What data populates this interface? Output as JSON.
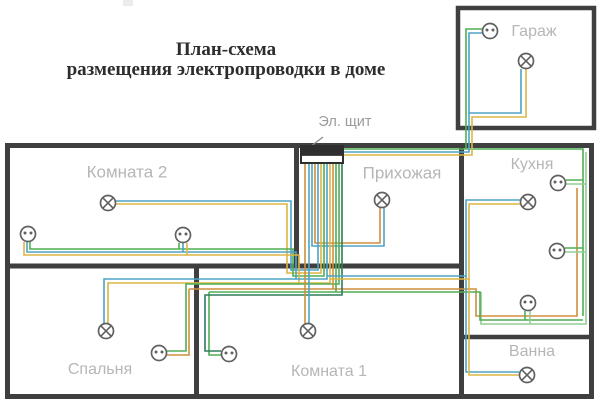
{
  "title": {
    "line1": "План-схема",
    "line2": "размещения электропроводки в доме"
  },
  "colors": {
    "wall": "#3f3f3f",
    "teal": "#4ea3c4",
    "yellow": "#dcb544",
    "green": "#4fae54",
    "lgreen": "#93cb94",
    "orange": "#cf8f3e",
    "dgreen": "#2e7d5b",
    "symbol_stroke": "#606060",
    "label_gray": "#b6b6b6",
    "panel_label_gray": "#9c9c9c",
    "title_color": "#2d2d2d"
  },
  "labels": [
    {
      "name": "room-label-garage",
      "text": "Гараж",
      "x": 534,
      "y": 32,
      "size": 16,
      "color": "#b6b6b6"
    },
    {
      "name": "room-label-room2",
      "text": "Комната 2",
      "x": 127,
      "y": 173,
      "size": 17,
      "color": "#b6b6b6"
    },
    {
      "name": "room-label-hallway",
      "text": "Прихожая",
      "x": 402,
      "y": 174,
      "size": 17,
      "color": "#b6b6b6"
    },
    {
      "name": "room-label-kitchen",
      "text": "Кухня",
      "x": 532,
      "y": 165,
      "size": 16,
      "color": "#b6b6b6"
    },
    {
      "name": "panel-label",
      "text": "Эл. щит",
      "x": 345,
      "y": 122,
      "size": 14.5,
      "color": "#9c9c9c"
    },
    {
      "name": "room-label-bedroom",
      "text": "Спальня",
      "x": 100,
      "y": 370,
      "size": 16,
      "color": "#b6b6b6"
    },
    {
      "name": "room-label-room1",
      "text": "Комната 1",
      "x": 329,
      "y": 372,
      "size": 16,
      "color": "#b6b6b6"
    },
    {
      "name": "room-label-bath",
      "text": "Ванна",
      "x": 532,
      "y": 352,
      "size": 16,
      "color": "#b6b6b6"
    }
  ],
  "walls": [
    {
      "x": 7.5,
      "y": 145.5,
      "w": 584,
      "h": 251,
      "sw": 5
    },
    {
      "x": 458,
      "y": 8,
      "w": 136,
      "h": 120,
      "sw": 4.5
    },
    {
      "x1": 296.5,
      "y1": 145,
      "x2": 296.5,
      "y2": 266,
      "sw": 5
    },
    {
      "x1": 5,
      "y1": 266,
      "x2": 461,
      "y2": 266,
      "sw": 5
    },
    {
      "x1": 461.5,
      "y1": 145,
      "x2": 461.5,
      "y2": 397,
      "sw": 5
    },
    {
      "x1": 196.5,
      "y1": 266,
      "x2": 196.5,
      "y2": 397,
      "sw": 5
    },
    {
      "x1": 459,
      "y1": 337,
      "x2": 592,
      "y2": 337,
      "sw": 4.5
    }
  ],
  "panel": {
    "x": 301,
    "y": 146,
    "w": 42,
    "h": 17,
    "pointer": [
      323,
      137,
      310,
      147
    ]
  },
  "wires": [
    {
      "color": "green",
      "points": [
        [
          343,
          149
        ],
        [
          583,
          149
        ],
        [
          583,
          316
        ]
      ]
    },
    {
      "color": "green",
      "points": [
        [
          466,
          149
        ],
        [
          466,
          29
        ],
        [
          482,
          29
        ]
      ]
    },
    {
      "color": "teal",
      "points": [
        [
          343,
          152
        ],
        [
          469,
          152
        ],
        [
          469,
          33
        ],
        [
          482,
          33
        ]
      ]
    },
    {
      "color": "teal",
      "points": [
        [
          469,
          113
        ],
        [
          521,
          113
        ],
        [
          521,
          69
        ]
      ]
    },
    {
      "color": "yellow",
      "points": [
        [
          343,
          155
        ],
        [
          472,
          155
        ],
        [
          472,
          117
        ],
        [
          526,
          117
        ],
        [
          526,
          69
        ]
      ]
    },
    {
      "color": "lgreen",
      "points": [
        [
          586,
          152
        ],
        [
          586,
          324
        ],
        [
          481,
          324
        ],
        [
          481,
          292
        ]
      ]
    },
    {
      "color": "orange",
      "points": [
        [
          315,
          163
        ],
        [
          315,
          243
        ],
        [
          380,
          243
        ],
        [
          380,
          208
        ]
      ]
    },
    {
      "color": "teal",
      "points": [
        [
          312,
          163
        ],
        [
          312,
          246
        ],
        [
          384,
          246
        ],
        [
          384,
          208
        ]
      ]
    },
    {
      "color": "teal",
      "points": [
        [
          115,
          201
        ],
        [
          291,
          201
        ],
        [
          291,
          270
        ],
        [
          318,
          270
        ],
        [
          318,
          163
        ]
      ]
    },
    {
      "color": "yellow",
      "points": [
        [
          115,
          204
        ],
        [
          287,
          204
        ],
        [
          287,
          273
        ],
        [
          321,
          273
        ],
        [
          321,
          163
        ]
      ]
    },
    {
      "color": "green",
      "points": [
        [
          30,
          242
        ],
        [
          30,
          249
        ],
        [
          293,
          249
        ],
        [
          293,
          276
        ],
        [
          324,
          276
        ],
        [
          324,
          163
        ]
      ]
    },
    {
      "color": "teal",
      "points": [
        [
          27,
          242
        ],
        [
          27,
          252
        ],
        [
          296,
          252
        ],
        [
          296,
          279
        ]
      ]
    },
    {
      "color": "yellow",
      "points": [
        [
          24,
          242
        ],
        [
          24,
          255
        ],
        [
          299,
          255
        ],
        [
          299,
          283
        ]
      ]
    },
    {
      "color": "green",
      "points": [
        [
          179,
          243
        ],
        [
          179,
          249
        ]
      ]
    },
    {
      "color": "teal",
      "points": [
        [
          183,
          243
        ],
        [
          183,
          252
        ]
      ]
    },
    {
      "color": "yellow",
      "points": [
        [
          187,
          243
        ],
        [
          187,
          255
        ]
      ]
    },
    {
      "color": "teal",
      "points": [
        [
          327,
          163
        ],
        [
          327,
          279
        ],
        [
          104,
          279
        ],
        [
          104,
          324
        ]
      ]
    },
    {
      "color": "yellow",
      "points": [
        [
          330,
          163
        ],
        [
          330,
          283
        ],
        [
          108,
          283
        ],
        [
          108,
          324
        ]
      ]
    },
    {
      "color": "green",
      "points": [
        [
          339,
          163
        ],
        [
          339,
          284
        ],
        [
          186,
          284
        ],
        [
          186,
          351
        ],
        [
          167,
          351
        ]
      ]
    },
    {
      "color": "orange",
      "points": [
        [
          167,
          355
        ],
        [
          189,
          355
        ],
        [
          189,
          289
        ]
      ]
    },
    {
      "color": "orange",
      "points": [
        [
          333,
          163
        ],
        [
          333,
          289
        ]
      ]
    },
    {
      "color": "orange",
      "points": [
        [
          189,
          289
        ],
        [
          476,
          289
        ],
        [
          476,
          316
        ],
        [
          577,
          316
        ],
        [
          577,
          188
        ]
      ]
    },
    {
      "color": "green",
      "points": [
        [
          209,
          292
        ],
        [
          480,
          292
        ],
        [
          480,
          320
        ],
        [
          583,
          320
        ]
      ]
    },
    {
      "color": "green",
      "points": [
        [
          336,
          163
        ],
        [
          336,
          292
        ]
      ]
    },
    {
      "color": "green",
      "points": [
        [
          221,
          355
        ],
        [
          209,
          355
        ],
        [
          209,
          292
        ]
      ]
    },
    {
      "color": "dgreen",
      "points": [
        [
          221,
          351
        ],
        [
          205,
          351
        ],
        [
          205,
          295
        ],
        [
          342,
          295
        ],
        [
          342,
          163
        ]
      ]
    },
    {
      "color": "orange",
      "points": [
        [
          305,
          163
        ],
        [
          305,
          324
        ]
      ]
    },
    {
      "color": "teal",
      "points": [
        [
          309,
          163
        ],
        [
          309,
          324
        ]
      ]
    },
    {
      "color": "teal",
      "points": [
        [
          327,
          276
        ],
        [
          466,
          276
        ],
        [
          466,
          200
        ],
        [
          520,
          200
        ]
      ]
    },
    {
      "color": "teal",
      "points": [
        [
          466,
          276
        ],
        [
          466,
          372
        ],
        [
          519,
          372
        ]
      ]
    },
    {
      "color": "yellow",
      "points": [
        [
          330,
          279
        ],
        [
          469,
          279
        ],
        [
          469,
          204
        ],
        [
          520,
          204
        ]
      ]
    },
    {
      "color": "yellow",
      "points": [
        [
          469,
          279
        ],
        [
          469,
          375
        ],
        [
          519,
          375
        ]
      ]
    },
    {
      "color": "green",
      "points": [
        [
          566,
          180
        ],
        [
          583,
          180
        ]
      ]
    },
    {
      "color": "lgreen",
      "points": [
        [
          566,
          184
        ],
        [
          586,
          184
        ]
      ]
    },
    {
      "color": "green",
      "points": [
        [
          565,
          248
        ],
        [
          583,
          248
        ]
      ]
    },
    {
      "color": "lgreen",
      "points": [
        [
          565,
          252
        ],
        [
          586,
          252
        ]
      ]
    },
    {
      "color": "green",
      "points": [
        [
          525,
          320
        ],
        [
          525,
          311
        ]
      ]
    },
    {
      "color": "lgreen",
      "points": [
        [
          530,
          324
        ],
        [
          530,
          311
        ]
      ]
    }
  ],
  "symbols": [
    {
      "type": "socket",
      "name": "socket-icon-garage",
      "x": 490,
      "y": 31
    },
    {
      "type": "lamp",
      "name": "lamp-icon-garage",
      "x": 526,
      "y": 61
    },
    {
      "type": "lamp",
      "name": "lamp-icon-room2",
      "x": 108,
      "y": 203
    },
    {
      "type": "socket",
      "name": "socket-icon-room2-left",
      "x": 28,
      "y": 234
    },
    {
      "type": "socket",
      "name": "socket-icon-room2-right",
      "x": 183,
      "y": 235
    },
    {
      "type": "lamp",
      "name": "lamp-icon-hallway",
      "x": 382,
      "y": 200
    },
    {
      "type": "lamp",
      "name": "lamp-icon-kitchen",
      "x": 528,
      "y": 202
    },
    {
      "type": "socket",
      "name": "socket-icon-kitchen-top",
      "x": 558,
      "y": 183
    },
    {
      "type": "socket",
      "name": "socket-icon-kitchen-mid",
      "x": 557,
      "y": 251
    },
    {
      "type": "socket",
      "name": "socket-icon-kitchen-bottom",
      "x": 528,
      "y": 303
    },
    {
      "type": "lamp",
      "name": "lamp-icon-bedroom",
      "x": 106,
      "y": 331
    },
    {
      "type": "socket",
      "name": "socket-icon-bedroom",
      "x": 159,
      "y": 353
    },
    {
      "type": "socket",
      "name": "socket-icon-room1",
      "x": 229,
      "y": 354
    },
    {
      "type": "lamp",
      "name": "lamp-icon-room1",
      "x": 308,
      "y": 331
    },
    {
      "type": "lamp",
      "name": "lamp-icon-bath",
      "x": 527,
      "y": 375
    }
  ]
}
